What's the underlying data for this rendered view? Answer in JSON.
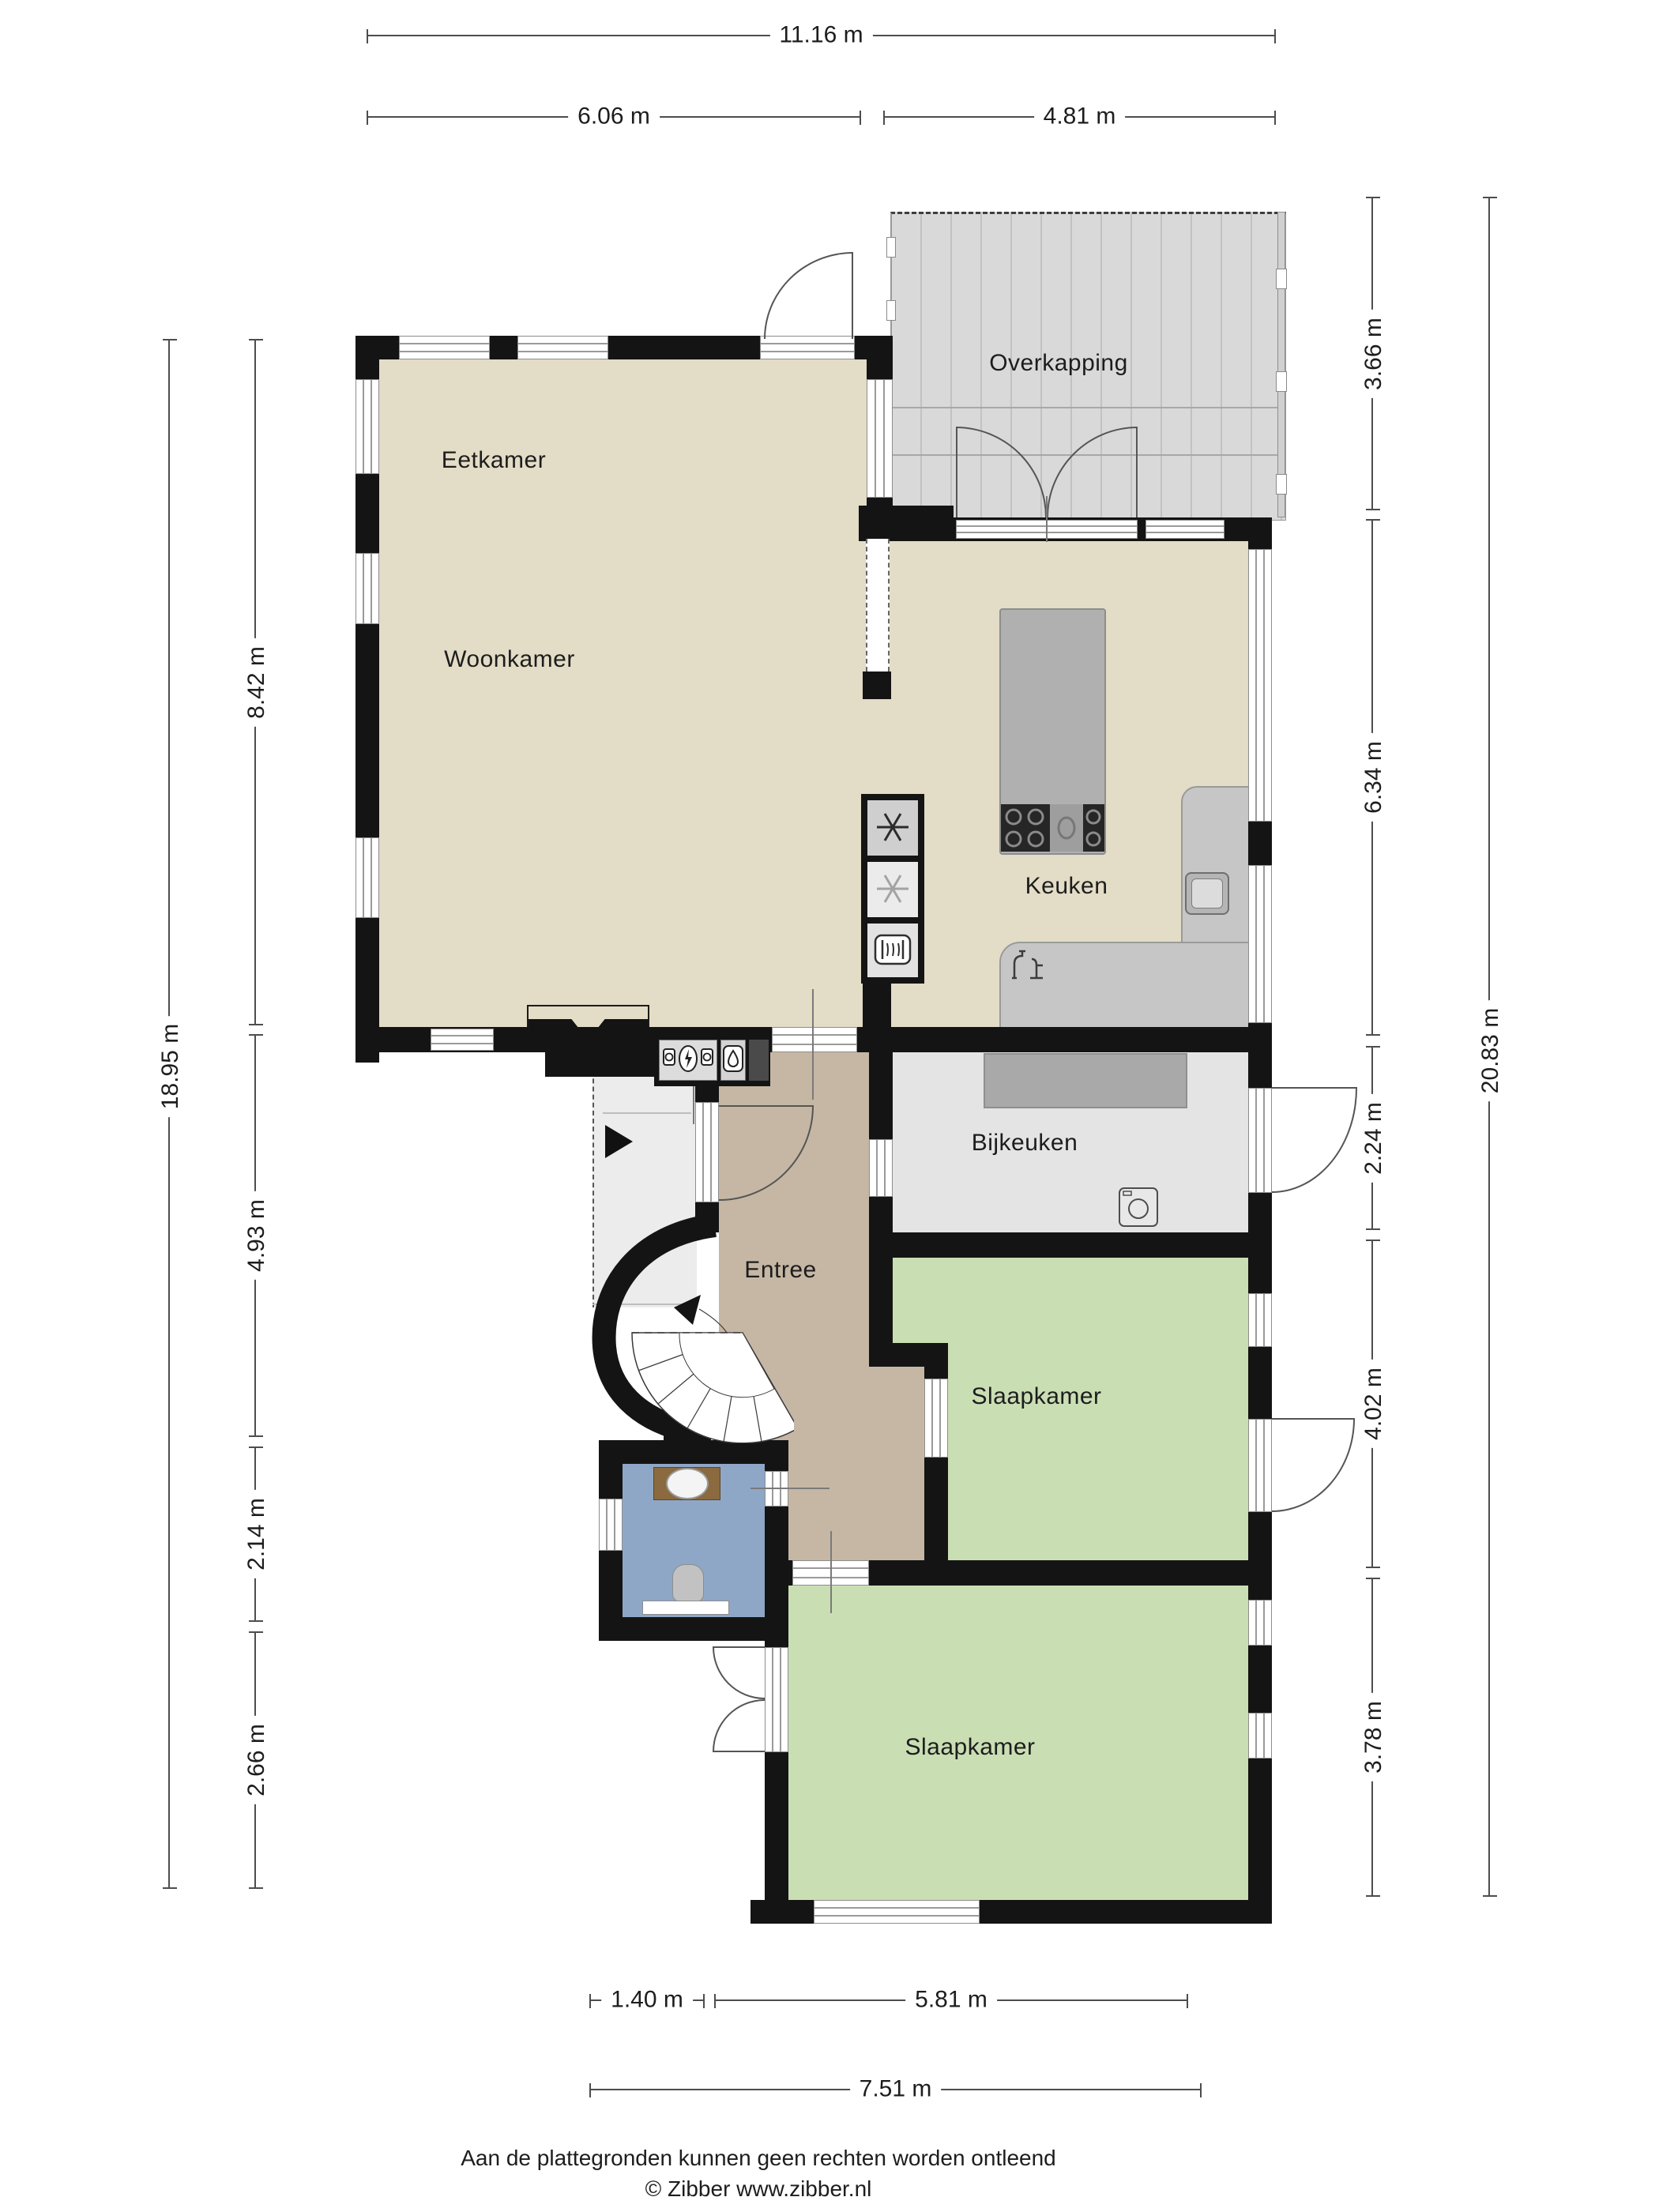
{
  "rooms": {
    "overkapping": "Overkapping",
    "eetkamer": "Eetkamer",
    "woonkamer": "Woonkamer",
    "keuken": "Keuken",
    "bijkeuken": "Bijkeuken",
    "entree": "Entree",
    "slaapkamer1": "Slaapkamer",
    "slaapkamer2": "Slaapkamer"
  },
  "dimensions": {
    "top_total": "11.16 m",
    "top_left": "6.06 m",
    "top_right": "4.81 m",
    "left_outer": "18.95 m",
    "left_living": "8.42 m",
    "left_entree": "4.93 m",
    "left_bath": "2.14 m",
    "left_bottom": "2.66 m",
    "right_outer": "20.83 m",
    "right_overkapping": "3.66 m",
    "right_keuken": "6.34 m",
    "right_bijkeuken": "2.24 m",
    "right_slaapkamer1": "4.02 m",
    "right_slaapkamer2": "3.78 m",
    "bottom_door": "1.40 m",
    "bottom_bedroom": "5.81 m",
    "bottom_total": "7.51 m"
  },
  "footer": {
    "line1": "Aan de plattegronden kunnen geen rechten worden ontleend",
    "line2": "© Zibber www.zibber.nl"
  },
  "colors": {
    "wall": "#141414",
    "floor_living": "#e3dcc6",
    "floor_entree": "#c6b7a5",
    "floor_bedroom": "#cadeb4",
    "floor_bathroom": "#8fa7c6",
    "floor_utility": "#e4e4e4",
    "deck": "#d9d9d9",
    "porch": "#ececec"
  }
}
